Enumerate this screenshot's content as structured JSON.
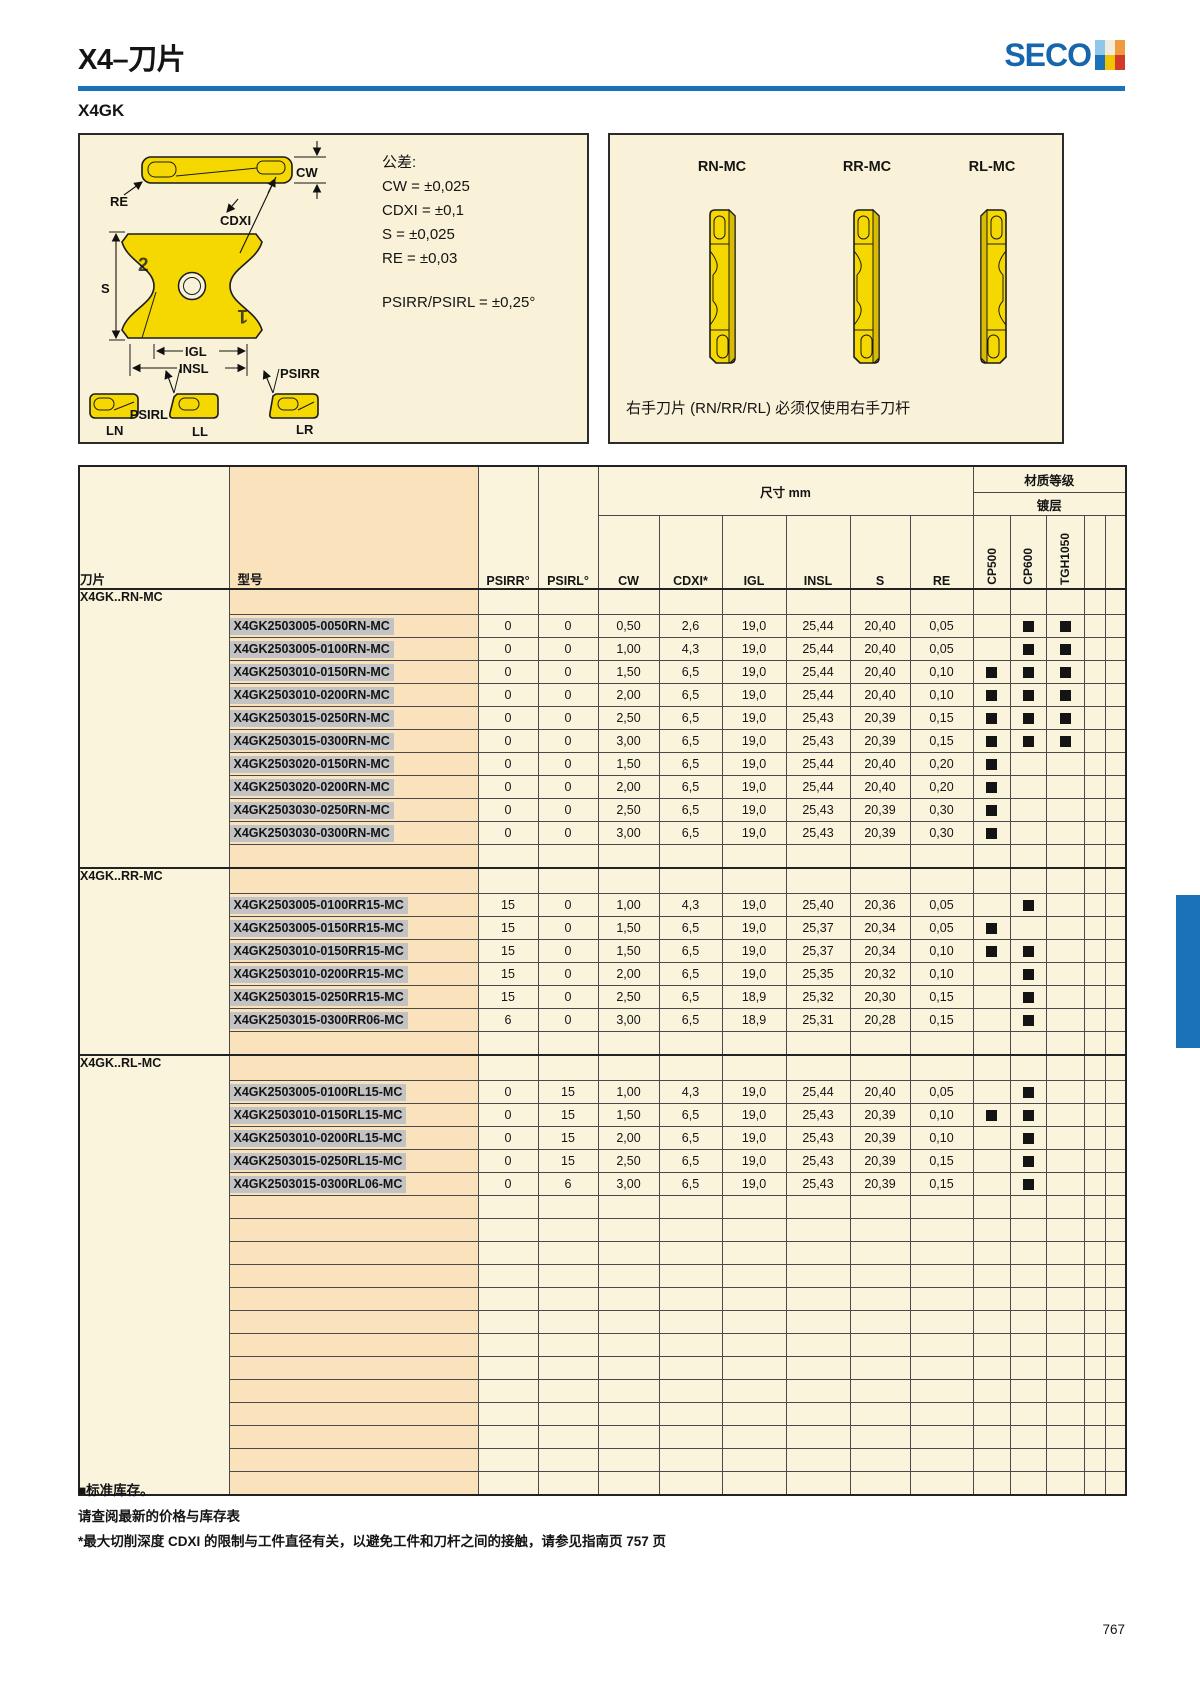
{
  "page": {
    "title": "X4–刀片",
    "brand": "SECO",
    "subtitle": "X4GK",
    "page_number": "767"
  },
  "colors": {
    "seco_blue": "#1B72B8",
    "insert_yellow": "#F5D800",
    "table_cream": "#FBF4DC",
    "model_column_orange": "#F9E2BC",
    "part_number_highlight": "#C3C3C3",
    "stock_square_black": "#141414",
    "logo_mark_colors": [
      "#8FC6EA",
      "#F2ECDC",
      "#EF9A3C",
      "#1B72B8",
      "#F2C300",
      "#D13A2B"
    ]
  },
  "diagram_left": {
    "labels": {
      "cw": "CW",
      "re": "RE",
      "cdxi": "CDXI",
      "s": "S",
      "igl": "IGL",
      "insl": "INSL",
      "psirr": "PSIRR",
      "psirl": "PSIRL",
      "ln": "LN",
      "ll": "LL",
      "lr": "LR",
      "mark1": "1",
      "mark2": "2"
    },
    "tolerances": {
      "heading": "公差:",
      "lines": [
        "CW = ±0,025",
        "CDXI = ±0,1",
        "S = ±0,025",
        "RE = ±0,03"
      ],
      "angle": "PSIRR/PSIRL = ±0,25°"
    }
  },
  "diagram_right": {
    "variants": [
      "RN-MC",
      "RR-MC",
      "RL-MC"
    ],
    "note": "右手刀片 (RN/RR/RL) 必须仅使用右手刀杆"
  },
  "table": {
    "header": {
      "insert": "刀片",
      "model": "型号",
      "psirr": "PSIRR°",
      "psirl": "PSIRL°",
      "dims_group": "尺寸 mm",
      "grade_group": "材质等级",
      "coating_group": "镀层",
      "dims": [
        "CW",
        "CDXI*",
        "IGL",
        "INSL",
        "S",
        "RE"
      ],
      "grades": [
        "CP500",
        "CP600",
        "TGH1050"
      ]
    },
    "groups": [
      {
        "name": "X4GK..RN-MC",
        "rows": [
          {
            "model": "X4GK2503005-0050RN-MC",
            "psirr": "0",
            "psirl": "0",
            "cw": "0,50",
            "cdxi": "2,6",
            "igl": "19,0",
            "insl": "25,44",
            "s": "20,40",
            "re": "0,05",
            "grades": [
              0,
              1,
              1
            ]
          },
          {
            "model": "X4GK2503005-0100RN-MC",
            "psirr": "0",
            "psirl": "0",
            "cw": "1,00",
            "cdxi": "4,3",
            "igl": "19,0",
            "insl": "25,44",
            "s": "20,40",
            "re": "0,05",
            "grades": [
              0,
              1,
              1
            ]
          },
          {
            "model": "X4GK2503010-0150RN-MC",
            "psirr": "0",
            "psirl": "0",
            "cw": "1,50",
            "cdxi": "6,5",
            "igl": "19,0",
            "insl": "25,44",
            "s": "20,40",
            "re": "0,10",
            "grades": [
              1,
              1,
              1
            ]
          },
          {
            "model": "X4GK2503010-0200RN-MC",
            "psirr": "0",
            "psirl": "0",
            "cw": "2,00",
            "cdxi": "6,5",
            "igl": "19,0",
            "insl": "25,44",
            "s": "20,40",
            "re": "0,10",
            "grades": [
              1,
              1,
              1
            ]
          },
          {
            "model": "X4GK2503015-0250RN-MC",
            "psirr": "0",
            "psirl": "0",
            "cw": "2,50",
            "cdxi": "6,5",
            "igl": "19,0",
            "insl": "25,43",
            "s": "20,39",
            "re": "0,15",
            "grades": [
              1,
              1,
              1
            ]
          },
          {
            "model": "X4GK2503015-0300RN-MC",
            "psirr": "0",
            "psirl": "0",
            "cw": "3,00",
            "cdxi": "6,5",
            "igl": "19,0",
            "insl": "25,43",
            "s": "20,39",
            "re": "0,15",
            "grades": [
              1,
              1,
              1
            ]
          },
          {
            "model": "X4GK2503020-0150RN-MC",
            "psirr": "0",
            "psirl": "0",
            "cw": "1,50",
            "cdxi": "6,5",
            "igl": "19,0",
            "insl": "25,44",
            "s": "20,40",
            "re": "0,20",
            "grades": [
              1,
              0,
              0
            ]
          },
          {
            "model": "X4GK2503020-0200RN-MC",
            "psirr": "0",
            "psirl": "0",
            "cw": "2,00",
            "cdxi": "6,5",
            "igl": "19,0",
            "insl": "25,44",
            "s": "20,40",
            "re": "0,20",
            "grades": [
              1,
              0,
              0
            ]
          },
          {
            "model": "X4GK2503030-0250RN-MC",
            "psirr": "0",
            "psirl": "0",
            "cw": "2,50",
            "cdxi": "6,5",
            "igl": "19,0",
            "insl": "25,43",
            "s": "20,39",
            "re": "0,30",
            "grades": [
              1,
              0,
              0
            ]
          },
          {
            "model": "X4GK2503030-0300RN-MC",
            "psirr": "0",
            "psirl": "0",
            "cw": "3,00",
            "cdxi": "6,5",
            "igl": "19,0",
            "insl": "25,43",
            "s": "20,39",
            "re": "0,30",
            "grades": [
              1,
              0,
              0
            ]
          }
        ]
      },
      {
        "name": "X4GK..RR-MC",
        "rows": [
          {
            "model": "X4GK2503005-0100RR15-MC",
            "psirr": "15",
            "psirl": "0",
            "cw": "1,00",
            "cdxi": "4,3",
            "igl": "19,0",
            "insl": "25,40",
            "s": "20,36",
            "re": "0,05",
            "grades": [
              0,
              1,
              0
            ]
          },
          {
            "model": "X4GK2503005-0150RR15-MC",
            "psirr": "15",
            "psirl": "0",
            "cw": "1,50",
            "cdxi": "6,5",
            "igl": "19,0",
            "insl": "25,37",
            "s": "20,34",
            "re": "0,05",
            "grades": [
              1,
              0,
              0
            ]
          },
          {
            "model": "X4GK2503010-0150RR15-MC",
            "psirr": "15",
            "psirl": "0",
            "cw": "1,50",
            "cdxi": "6,5",
            "igl": "19,0",
            "insl": "25,37",
            "s": "20,34",
            "re": "0,10",
            "grades": [
              1,
              1,
              0
            ]
          },
          {
            "model": "X4GK2503010-0200RR15-MC",
            "psirr": "15",
            "psirl": "0",
            "cw": "2,00",
            "cdxi": "6,5",
            "igl": "19,0",
            "insl": "25,35",
            "s": "20,32",
            "re": "0,10",
            "grades": [
              0,
              1,
              0
            ]
          },
          {
            "model": "X4GK2503015-0250RR15-MC",
            "psirr": "15",
            "psirl": "0",
            "cw": "2,50",
            "cdxi": "6,5",
            "igl": "18,9",
            "insl": "25,32",
            "s": "20,30",
            "re": "0,15",
            "grades": [
              0,
              1,
              0
            ]
          },
          {
            "model": "X4GK2503015-0300RR06-MC",
            "psirr": "6",
            "psirl": "0",
            "cw": "3,00",
            "cdxi": "6,5",
            "igl": "18,9",
            "insl": "25,31",
            "s": "20,28",
            "re": "0,15",
            "grades": [
              0,
              1,
              0
            ]
          }
        ]
      },
      {
        "name": "X4GK..RL-MC",
        "rows": [
          {
            "model": "X4GK2503005-0100RL15-MC",
            "psirr": "0",
            "psirl": "15",
            "cw": "1,00",
            "cdxi": "4,3",
            "igl": "19,0",
            "insl": "25,44",
            "s": "20,40",
            "re": "0,05",
            "grades": [
              0,
              1,
              0
            ]
          },
          {
            "model": "X4GK2503010-0150RL15-MC",
            "psirr": "0",
            "psirl": "15",
            "cw": "1,50",
            "cdxi": "6,5",
            "igl": "19,0",
            "insl": "25,43",
            "s": "20,39",
            "re": "0,10",
            "grades": [
              1,
              1,
              0
            ]
          },
          {
            "model": "X4GK2503010-0200RL15-MC",
            "psirr": "0",
            "psirl": "15",
            "cw": "2,00",
            "cdxi": "6,5",
            "igl": "19,0",
            "insl": "25,43",
            "s": "20,39",
            "re": "0,10",
            "grades": [
              0,
              1,
              0
            ]
          },
          {
            "model": "X4GK2503015-0250RL15-MC",
            "psirr": "0",
            "psirl": "15",
            "cw": "2,50",
            "cdxi": "6,5",
            "igl": "19,0",
            "insl": "25,43",
            "s": "20,39",
            "re": "0,15",
            "grades": [
              0,
              1,
              0
            ]
          },
          {
            "model": "X4GK2503015-0300RL06-MC",
            "psirr": "0",
            "psirl": "6",
            "cw": "3,00",
            "cdxi": "6,5",
            "igl": "19,0",
            "insl": "25,43",
            "s": "20,39",
            "re": "0,15",
            "grades": [
              0,
              1,
              0
            ]
          }
        ]
      }
    ],
    "trailing_empty_rows": 13
  },
  "footnotes": [
    "■标准库存。",
    "请查阅最新的价格与库存表",
    "*最大切削深度 CDXI 的限制与工件直径有关，以避免工件和刀杆之间的接触，请参见指南页 757 页"
  ]
}
